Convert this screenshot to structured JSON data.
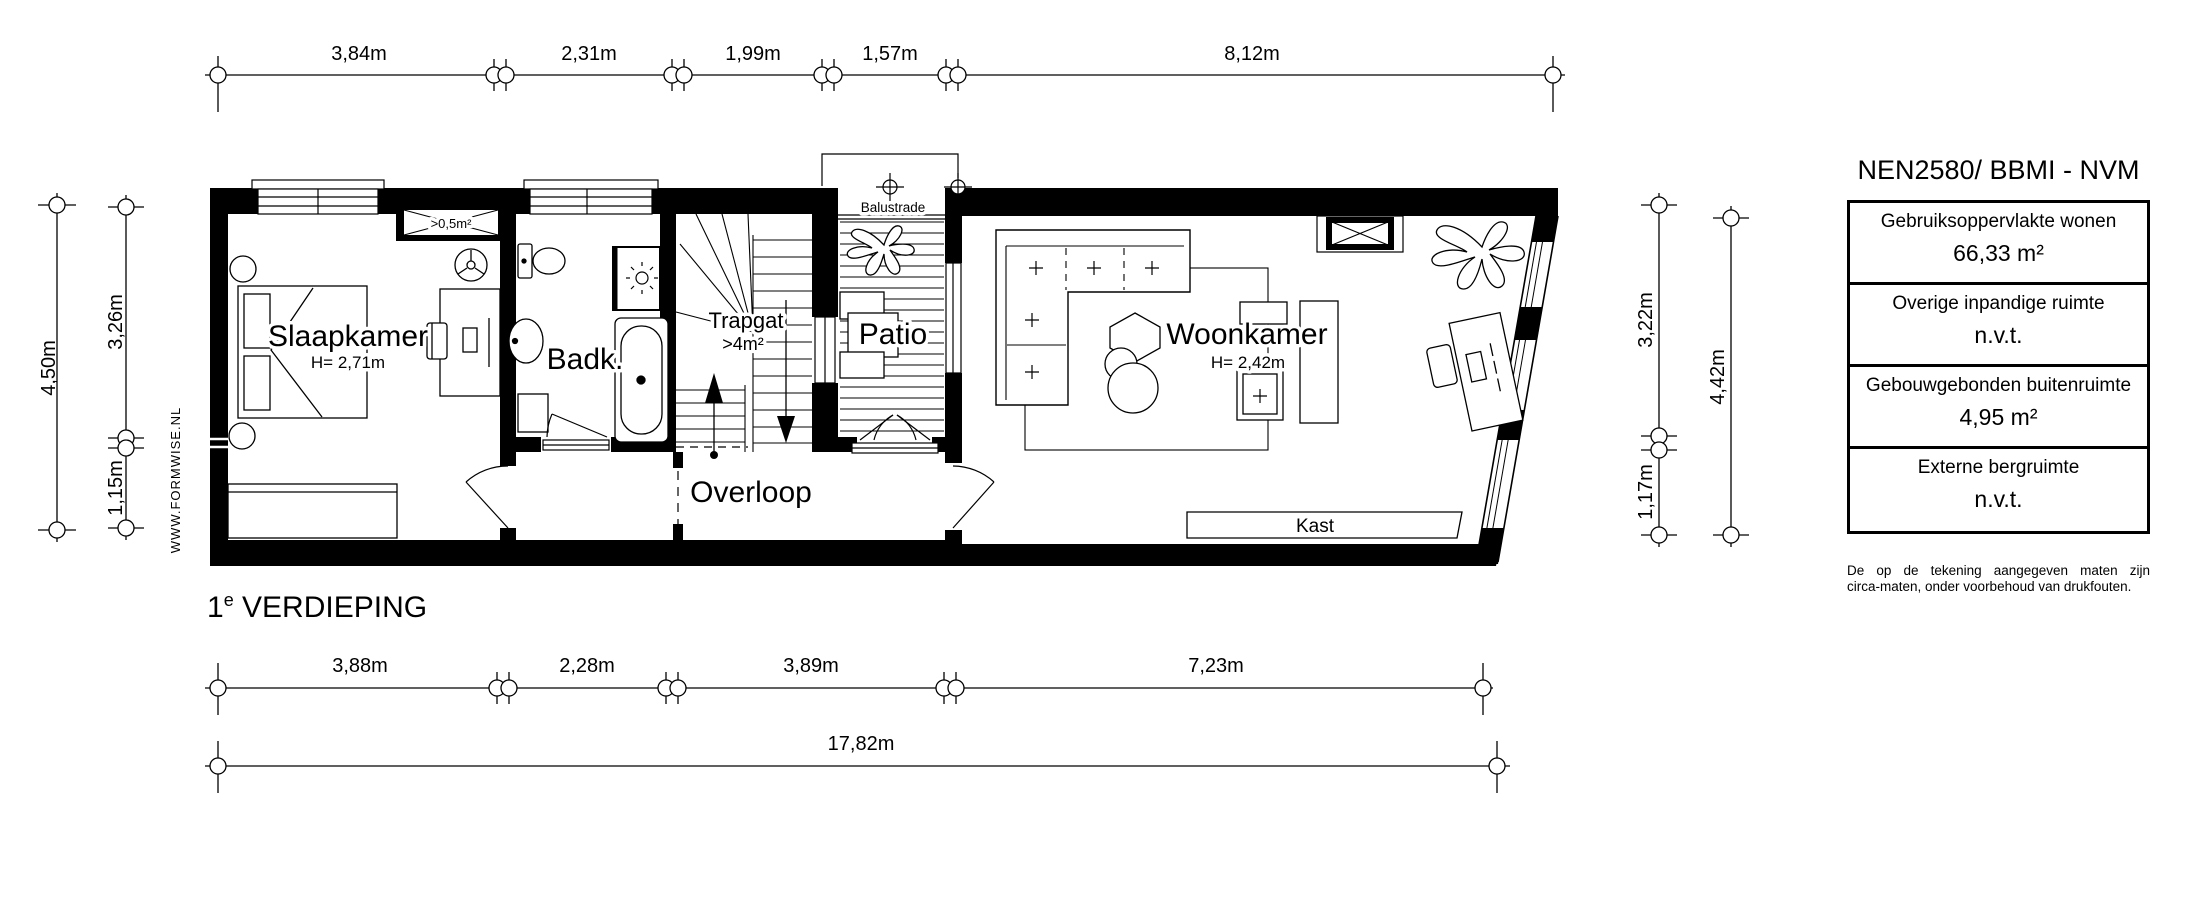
{
  "floor_title": {
    "number": "1",
    "sup": "e",
    "text": " VERDIEPING"
  },
  "watermark": "WWW.FORMWISE.NL",
  "rooms": {
    "slaapkamer": {
      "name": "Slaapkamer",
      "height": "H= 2,71m"
    },
    "badkamer": {
      "name": "Badk."
    },
    "trapgat": {
      "name": "Trapgat",
      "area": ">4m²"
    },
    "patio": {
      "name": "Patio",
      "balustrade": "Balustrade"
    },
    "woonkamer": {
      "name": "Woonkamer",
      "height": "H= 2,42m"
    },
    "overloop": {
      "name": "Overloop"
    },
    "kast": {
      "name": "Kast"
    }
  },
  "annotations": {
    "shaft": ">0,5m²"
  },
  "dimensions": {
    "top": [
      "3,84m",
      "2,31m",
      "1,99m",
      "1,57m",
      "8,12m"
    ],
    "bottom": [
      "3,88m",
      "2,28m",
      "3,89m",
      "7,23m"
    ],
    "bottom_total": "17,82m",
    "left_outer": "4,50m",
    "left_inner": [
      "3,26m",
      "1,15m"
    ],
    "right_inner": [
      "3,22m",
      "1,17m"
    ],
    "right_outer": "4,42m"
  },
  "legend": {
    "title": "NEN2580/ BBMI - NVM",
    "rows": [
      {
        "label": "Gebruiksoppervlakte wonen",
        "value": "66,33 m²"
      },
      {
        "label": "Overige inpandige ruimte",
        "value": "n.v.t."
      },
      {
        "label": "Gebouwgebonden buitenruimte",
        "value": "4,95 m²"
      },
      {
        "label": "Externe bergruimte",
        "value": "n.v.t."
      }
    ],
    "disclaimer_line1": "De op de tekening aangegeven maten zijn",
    "disclaimer_line2": "circa-maten, onder voorbehoud van drukfouten."
  },
  "colors": {
    "ink": "#000000",
    "paper": "#ffffff"
  }
}
